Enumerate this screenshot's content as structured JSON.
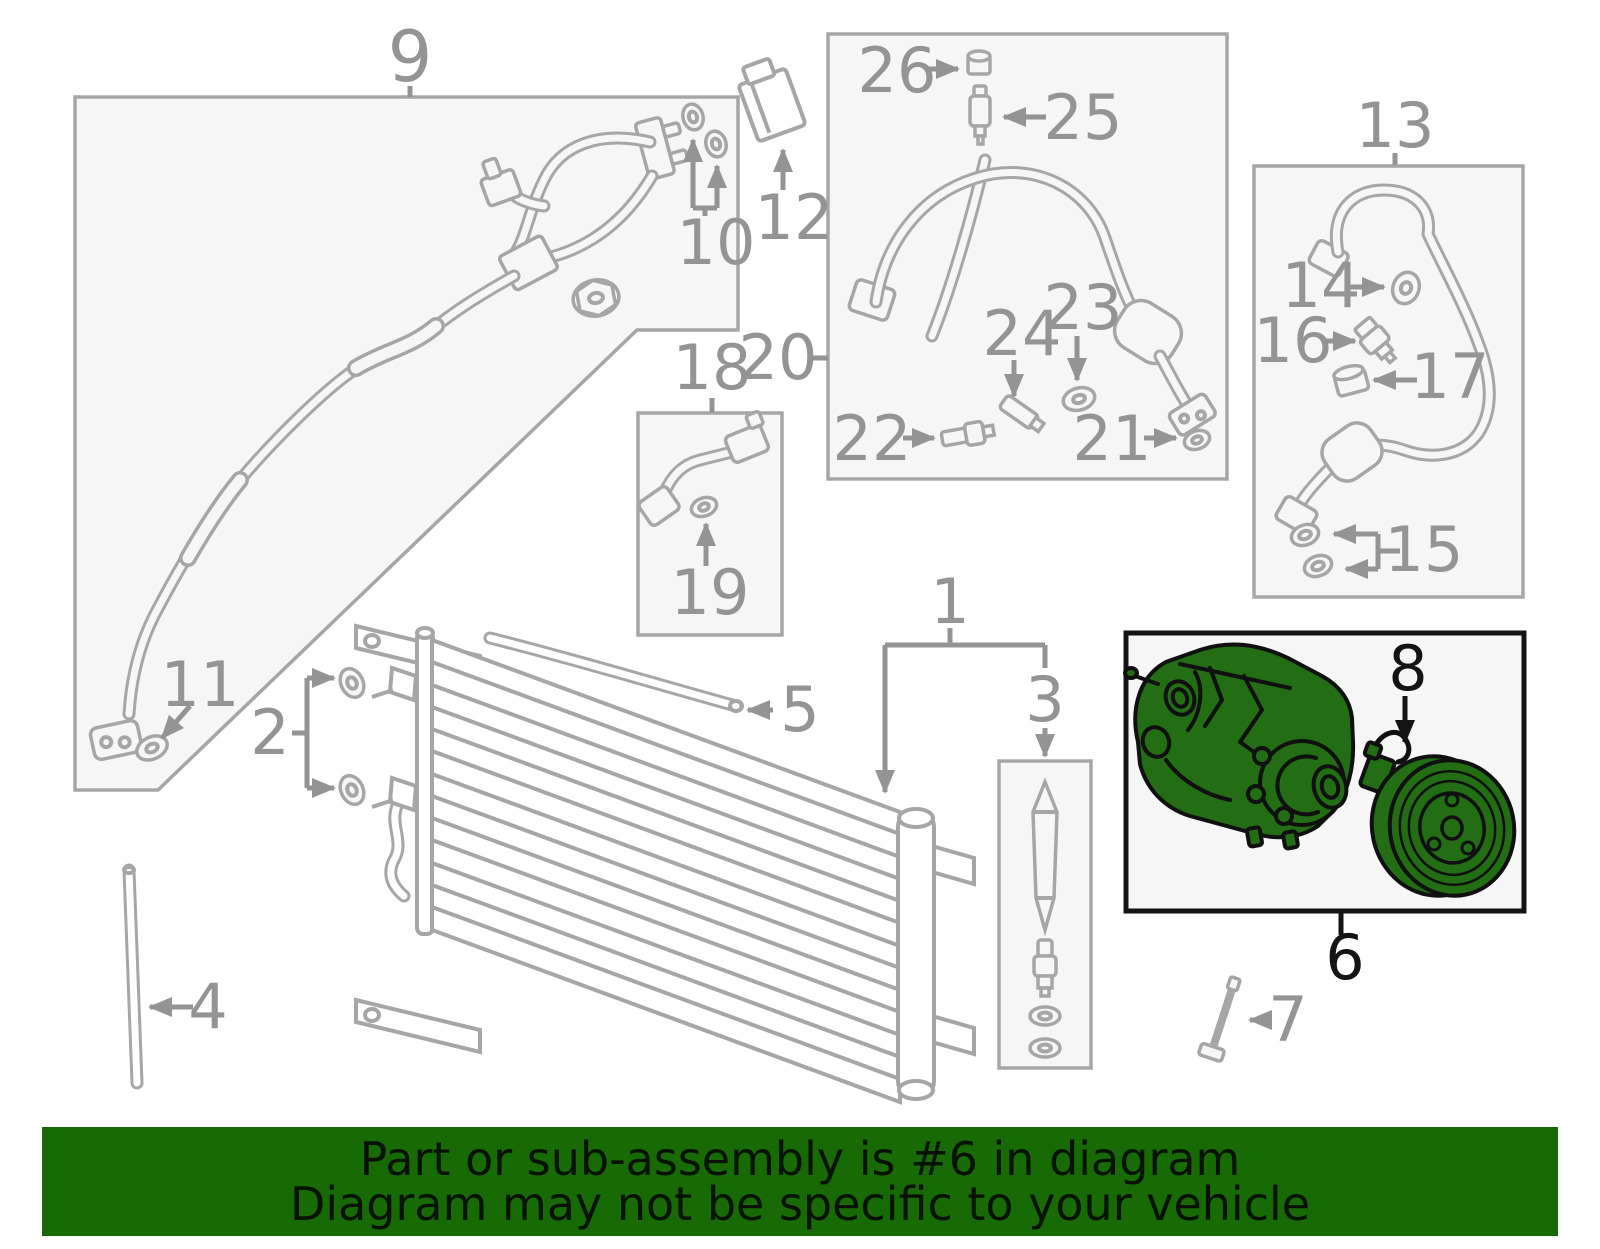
{
  "banner": {
    "line1": "Part or sub-assembly is #6 in diagram",
    "line2": "Diagram may not be specific to your vehicle"
  },
  "diagram": {
    "callouts": {
      "n1": "1",
      "n2": "2",
      "n3": "3",
      "n4": "4",
      "n5": "5",
      "n6": "6",
      "n7": "7",
      "n8": "8",
      "n9": "9",
      "n10": "10",
      "n11": "11",
      "n12": "12",
      "n13": "13",
      "n14": "14",
      "n15": "15",
      "n16": "16",
      "n17": "17",
      "n18": "18",
      "n19": "19",
      "n20": "20",
      "n21": "21",
      "n22": "22",
      "n23": "23",
      "n24": "24",
      "n25": "25",
      "n26": "26"
    },
    "highlighted_callouts": [
      "6",
      "8"
    ]
  },
  "colors": {
    "highlight_green": "#236e14",
    "banner_green": "#186a04",
    "diagram_line_gray": "#a6a6a6",
    "label_gray": "#949494",
    "box_fill": "#f6f6f6",
    "highlight_outline": "#101010"
  }
}
